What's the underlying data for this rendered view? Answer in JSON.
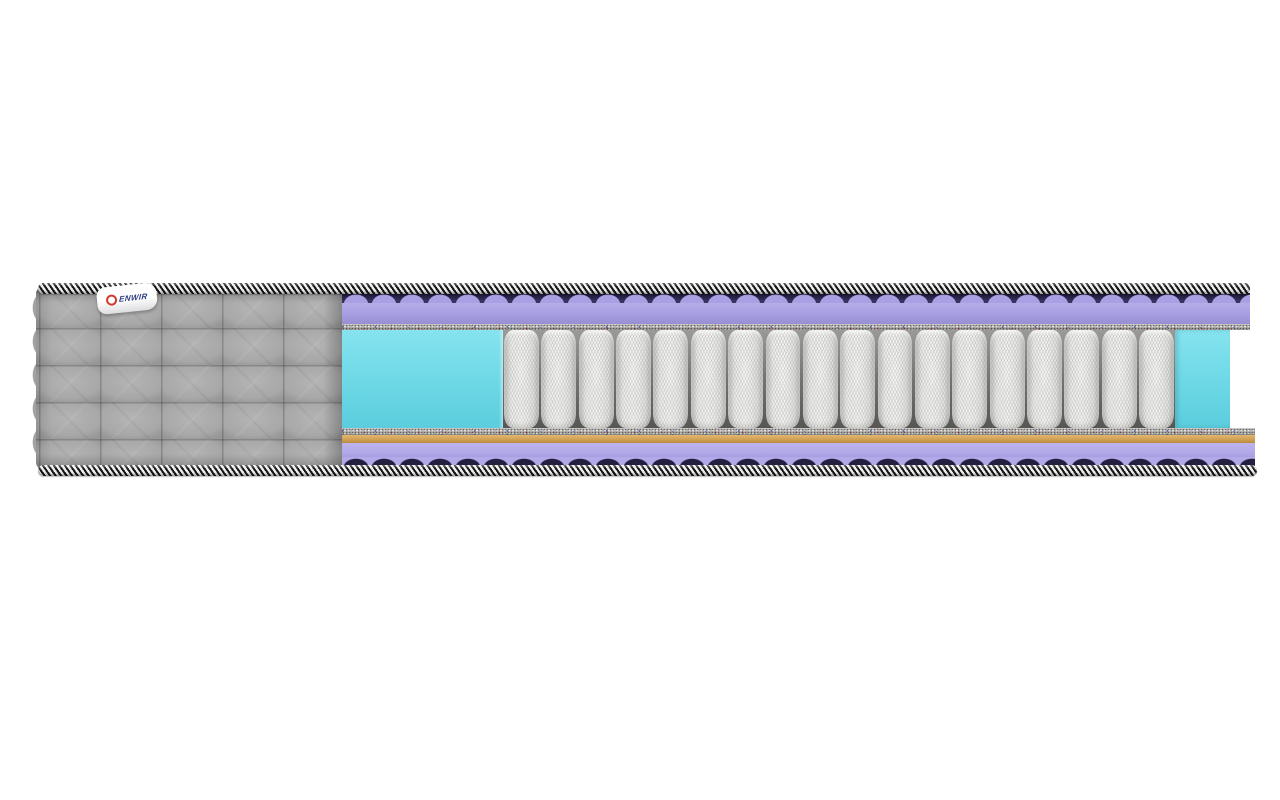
{
  "scene": {
    "description": "Cutaway product render of a pocket-spring mattress on a plain white background",
    "background_color": "#ffffff"
  },
  "brand": {
    "label_text": "DENWIR",
    "tag_text": "ENWIR",
    "logo": "red-ring-icon"
  },
  "colors": {
    "piping-dark": "#161616",
    "piping-light": "#efefef",
    "cover-gray": "#a8a8a8",
    "lavender": "#a8a0e3",
    "lavender-light": "#b2aae8",
    "wave-shadow": "#241f40",
    "felt-gray": "#b5b2ae",
    "coir-tan": "#d0a155",
    "cyan-foam": "#73dbe8",
    "spring-white": "#f4f4f2",
    "logo-red": "#d4392e",
    "logo-blue": "#2c3c80"
  },
  "structure": {
    "spring_count": 18,
    "quilt_grid": {
      "columns": 5,
      "rows": 5
    },
    "layers": [
      {
        "name": "quilted-cover",
        "color_key": "cover-gray"
      },
      {
        "name": "piping-cord-top",
        "color_key": "piping-dark"
      },
      {
        "name": "wavy-foam-top",
        "color_key": "lavender"
      },
      {
        "name": "felt-pad-top",
        "color_key": "felt-gray"
      },
      {
        "name": "foam-edge-frame",
        "color_key": "cyan-foam"
      },
      {
        "name": "pocket-spring-block",
        "color_key": "spring-white"
      },
      {
        "name": "felt-pad-bottom",
        "color_key": "felt-gray"
      },
      {
        "name": "coir-pad",
        "color_key": "coir-tan"
      },
      {
        "name": "wavy-foam-bottom",
        "color_key": "lavender-light"
      },
      {
        "name": "piping-cord-bottom",
        "color_key": "piping-dark"
      }
    ]
  }
}
